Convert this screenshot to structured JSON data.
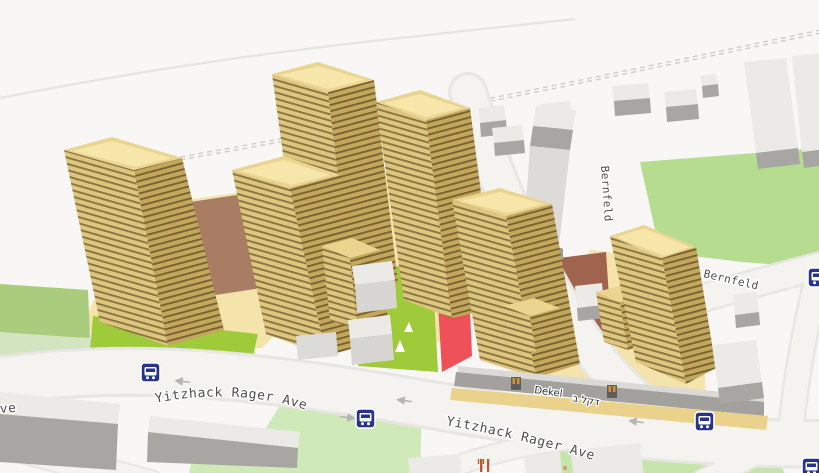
{
  "map": {
    "view": "3d-buildings-map",
    "streets": {
      "rager1": "Yitzhack Rager Ave",
      "rager2": "Yitzhack Rager Ave",
      "bernfeld_vertical": "Bernfeld",
      "bernfeld_horizontal": "Bernfeld",
      "partial_left_edge": "ve"
    },
    "pois": {
      "dekel_latin": "Dekel",
      "dekel_hebrew": "דקל ב",
      "house_number": "13"
    },
    "icons": {
      "bus_stop": "bus-stop-icon",
      "restaurant": "restaurant-icon",
      "one_way": "one-way-arrow-icon",
      "door": "entrance-door-icon"
    },
    "colors": {
      "background": "#f8f7f5",
      "road": "#f4f3f0",
      "road_casing": "#e8e6e2",
      "tower_face_light": "#ddc67e",
      "tower_face_dark": "#c3a75d",
      "roof_outer": "#ead490",
      "roof_inner": "#f6e6a9",
      "tan_ground": "#f5e3ac",
      "lime_green": "#9fcb3b",
      "sage_pale": "#d3e4c0",
      "sage_medium": "#a9cd7d",
      "park_pale": "#cfe9b9",
      "park_right": "#c6e5ab",
      "green_topright": "#b6dc90",
      "brown": "#a87d64",
      "brown_red": "#a0644e",
      "red_pitch": "#ee5157",
      "bus_blue": "#27338c",
      "podium_tan": "#ead28c",
      "podium_gray": "#a3a19d",
      "door_orange": "#d8902c",
      "restaurant_red": "#c2542f",
      "label_gray": "#4f4f4f"
    }
  }
}
